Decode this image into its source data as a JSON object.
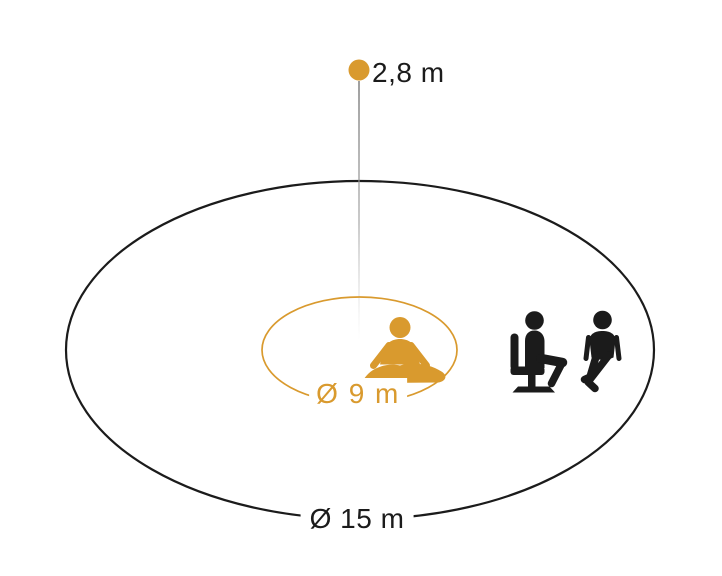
{
  "labels": {
    "mount_height": "2,8 m",
    "inner_diameter": "Ø 9 m",
    "outer_diameter": "Ø 15 m"
  },
  "colors": {
    "accent": "#D99A2E",
    "ink": "#1B1B1B",
    "guide_line_top": "#808080",
    "guide_line_bottom": "#C8C8C8"
  },
  "icons": {
    "sensor": "sensor-dot",
    "presence": "meditating-person-icon",
    "seated": "seated-person-icon",
    "motion": "walking-person-icon"
  }
}
